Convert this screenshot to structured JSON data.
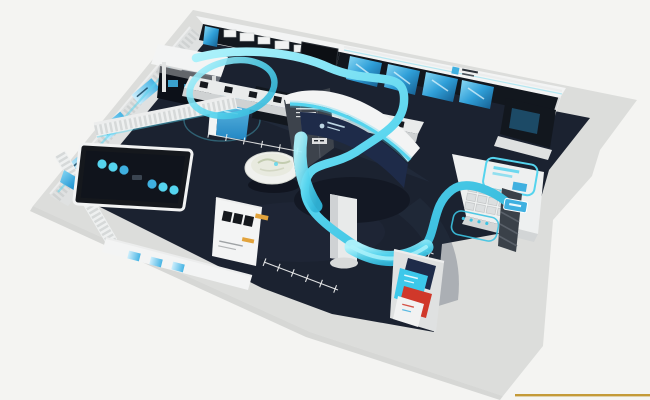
{
  "meta": {
    "type": "3d-architectural-render",
    "subject": "bird's-eye isometric rendering of a technology exhibition hall",
    "notes": "white walls and counters, dark navy floor, glowing cyan light ribbon winding through the space; no legible text in the image"
  },
  "colors": {
    "bg": "#f4f4f2",
    "plinth": "#dcdddb",
    "plinth_shade": "#c9cac9",
    "wall": "#f3f4f4",
    "wall_shade": "#dfe1e1",
    "floor": "#1b2230",
    "floor_light": "#2b374c",
    "floor_dark": "#0c1018",
    "panel_dark": "#12171e",
    "navy": "#1e2b49",
    "screen_blue": "#3fb0e0",
    "screen_blue_light": "#a8e0f6",
    "ribbon": "#55d4ee",
    "ribbon_light": "#aef2fb",
    "ribbon_deep": "#2fb4d8",
    "orange": "#e2a33c",
    "poster_red": "#d0382a",
    "poster_cyan": "#3cc8ea",
    "gold": "#c49a38",
    "line_white": "#eceded",
    "table_dark": "#10141c"
  },
  "components": {
    "hall": "L-shaped exhibition hall plinth with white perimeter walls",
    "north_wall": "dark display wall with product shelves, monitor and four glowing angled screens",
    "brand_sign": "small blue logo plaque on upper-right wall (illegible)",
    "left_room": "louvered room with black-framed interactive table and cyan pucks",
    "terrain_bowl": "white dish holding a miniature terrain model",
    "central_tower": "white curved Y-shaped tower with navy banner, cyan trim and round column",
    "light_ribbon": "cyan ribbon flowing from entrance loop, around tower, to reception desk",
    "reception_nook": "white desk with stepped keyboard terrace and cyan outlined wall sign",
    "poster_wall": "angled wall with colorful cyan/red posters near entrance",
    "partition": "small white partition with black screens and orange bars",
    "floor_markings": "white dimension lines with tick marks and cyan rounded-rectangle outlines",
    "gold_rule": "thin gold horizontal rule at bottom-right page edge"
  }
}
